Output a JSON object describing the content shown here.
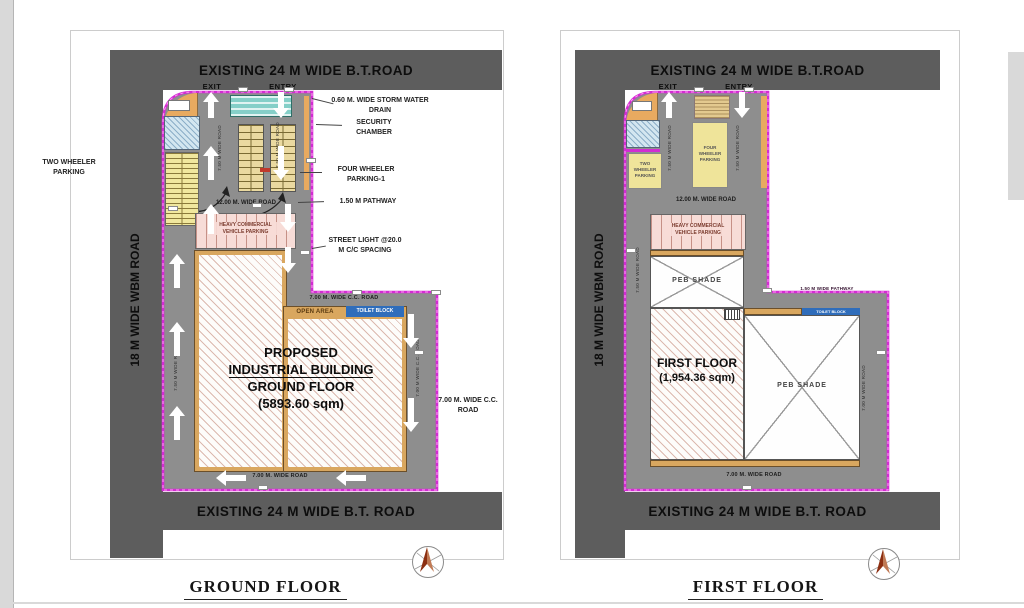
{
  "colors": {
    "road_gray": "#5d5d5d",
    "site_gray": "#8e8e8e",
    "boundary_magenta": "#d32cd3",
    "building_tan": "#d9a75f",
    "parking_yellow": "#efe49a",
    "parking_pink": "#f7dcd7",
    "toilet_blue": "#2f6dbb",
    "cabin_teal": "#85cfc8",
    "compass_red": "#8c2f12",
    "arrow_white": "#ffffff"
  },
  "ground_floor": {
    "title": "GROUND FLOOR",
    "roads": {
      "top": "EXISTING 24 M WIDE B.T.ROAD",
      "bottom": "EXISTING 24 M WIDE B.T. ROAD",
      "left": "18 M WIDE WBM ROAD",
      "internal_top": "12.00 M. WIDE ROAD",
      "internal_cc": "7.00 M. WIDE C.C. ROAD",
      "internal_bottom": "7.00 M. WIDE ROAD",
      "lane_exit": "7.50 M WIDE ROAD",
      "lane_entry": "7.50 M WIDE ROAD",
      "lane_left": "7.50 M WIDE ROAD",
      "lane_right": "7.00 M WIDE C.C. ROAD"
    },
    "gates": {
      "exit": "EXIT",
      "entry": "ENTRY"
    },
    "areas": {
      "heavy_parking": "HEAVY COMMERCIAL VEHICLE PARKING",
      "open_area": "OPEN AREA",
      "toilet_block": "TOILET BLOCK"
    },
    "building": {
      "line1": "PROPOSED",
      "line2": "INDUSTRIAL BUILDING",
      "line3": "GROUND FLOOR",
      "line4": "(5893.60 sqm)"
    },
    "annotations": {
      "two_wheeler": "TWO WHEELER PARKING",
      "storm_drain": "0.60 M. WIDE STORM WATER DRAIN",
      "security_chamber": "SECURITY CHAMBER",
      "four_wheeler": "FOUR WHEELER PARKING-1",
      "pathway": "1.50 M PATHWAY",
      "street_light": "STREET LIGHT @20.0 M C/C SPACING",
      "cc_road": "7.00 M. WIDE C.C. ROAD"
    }
  },
  "first_floor": {
    "title": "FIRST FLOOR",
    "roads": {
      "top": "EXISTING 24 M WIDE B.T.ROAD",
      "bottom": "EXISTING 24 M WIDE B.T. ROAD",
      "left": "18 M WIDE WBM ROAD",
      "internal_top": "12.00 M. WIDE ROAD",
      "internal_bottom": "7.00 M. WIDE ROAD",
      "pathway": "1.50 M WIDE PATHWAY",
      "lane_exit": "7.50 M WIDE ROAD",
      "lane_entry": "7.50 M WIDE ROAD",
      "lane_left": "7.50 M WIDE ROAD",
      "lane_right": "7.00 M WIDE ROAD"
    },
    "gates": {
      "exit": "EXIT",
      "entry": "ENTRY"
    },
    "areas": {
      "two_wheeler": "TWO WHEELER PARKING",
      "four_wheeler": "FOUR WHEELER PARKING",
      "heavy_parking": "HEAVY COMMERCIAL VEHICLE PARKING",
      "peb_shade_top": "PEB SHADE",
      "peb_shade_right": "PEB SHADE",
      "toilet_block": "TOILET BLOCK"
    },
    "floor_label": {
      "line1": "FIRST FLOOR",
      "line2": "(1,954.36 sqm)"
    }
  }
}
